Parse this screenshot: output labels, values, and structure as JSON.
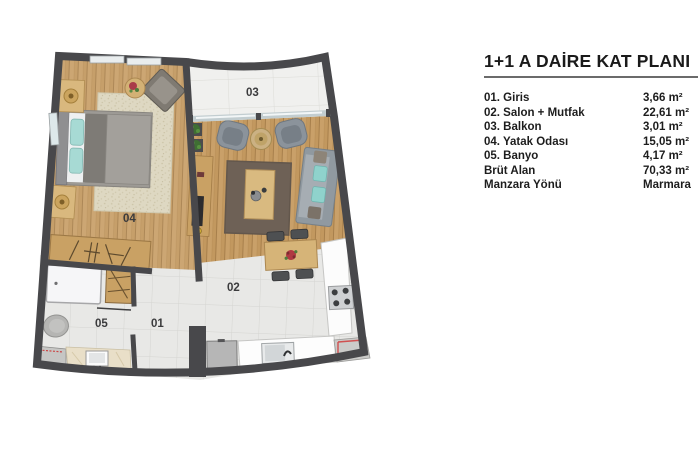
{
  "legend": {
    "title": "1+1 A DAİRE KAT PLANI",
    "rows": [
      {
        "label": "01. Giris",
        "value": "3,66 m²"
      },
      {
        "label": "02. Salon + Mutfak",
        "value": "22,61 m²"
      },
      {
        "label": "03. Balkon",
        "value": "3,01 m²"
      },
      {
        "label": "04. Yatak Odası",
        "value": "15,05 m²"
      },
      {
        "label": "05. Banyo",
        "value": "4,17 m²"
      },
      {
        "label": "Brüt Alan",
        "value": "70,33 m²"
      },
      {
        "label": "Manzara Yönü",
        "value": "Marmara"
      }
    ]
  },
  "plan": {
    "room_labels": {
      "giris": "01",
      "salon": "02",
      "balkon": "03",
      "yatak": "04",
      "banyo": "05"
    },
    "colors": {
      "wall": "#48484b",
      "wood": "#c2985f",
      "tile": "#e8e8e6",
      "balcony_tile": "#f0f0ee",
      "rug_dark": "#6e6156",
      "rug_light": "#ded8c2",
      "accent_red": "#c64747",
      "teal_pillow": "#8fd2cc"
    }
  }
}
